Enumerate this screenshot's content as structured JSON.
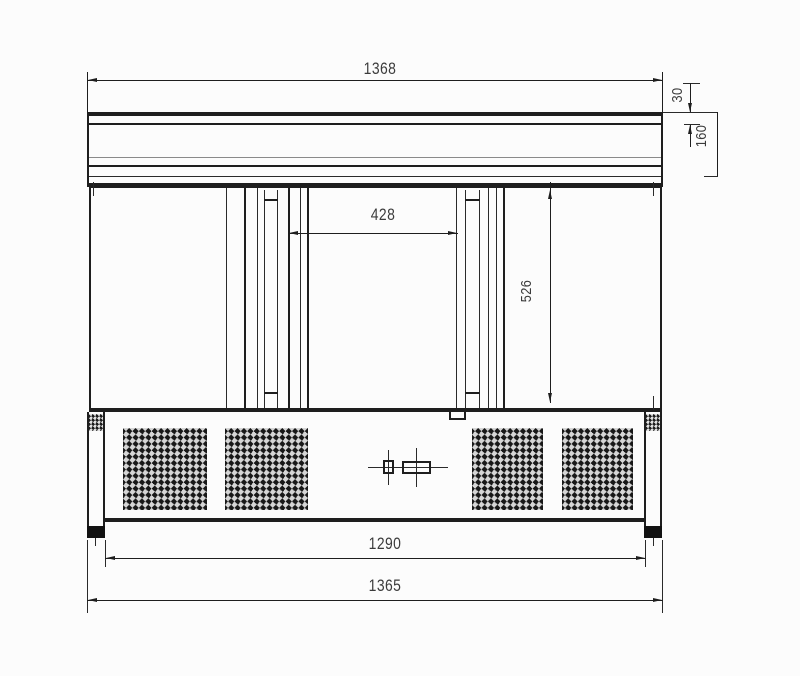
{
  "dimensions": {
    "overall_top_width": "1368",
    "worktop_thickness": "30",
    "top_section_height": "160",
    "center_opening_width": "428",
    "door_height": "526",
    "base_inner_width": "1290",
    "base_outer_width": "1365"
  }
}
